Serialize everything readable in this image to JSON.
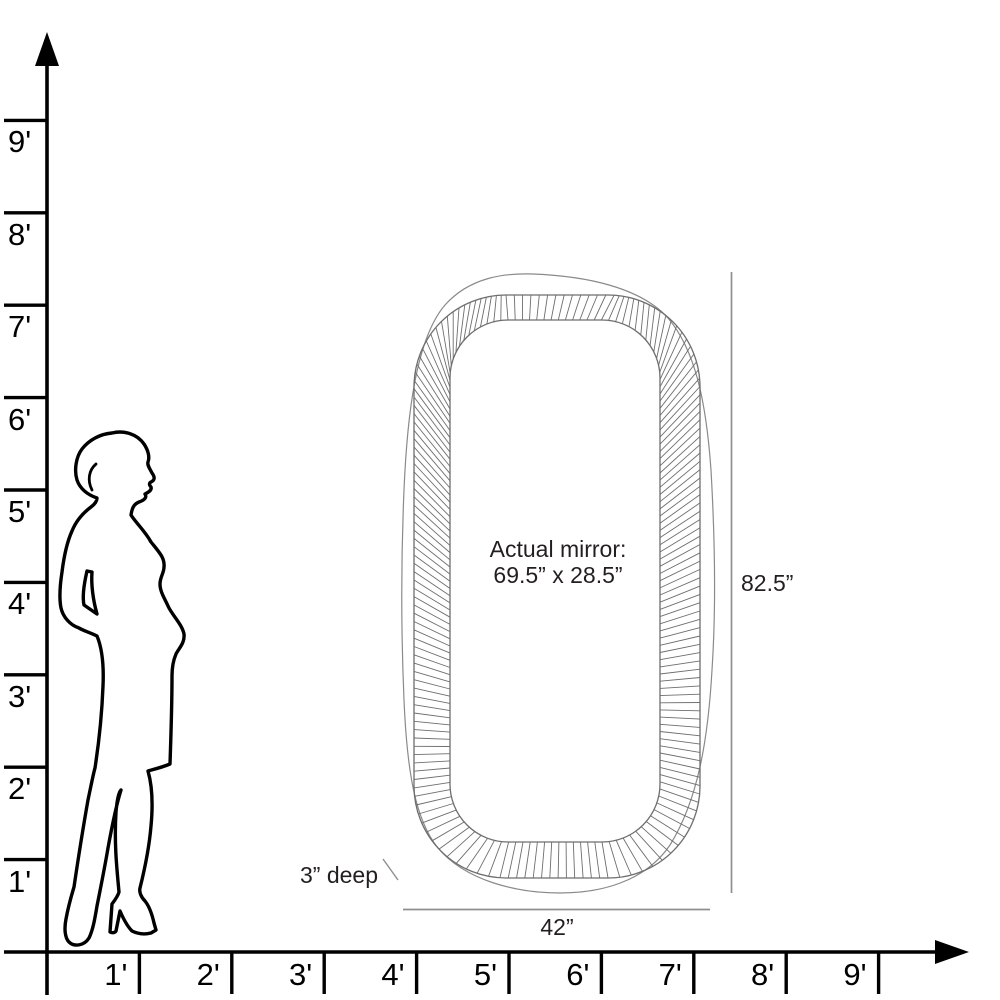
{
  "diagram": {
    "type": "product-size-comparison",
    "vertical_axis": {
      "unit": "feet",
      "labels": [
        "1'",
        "2'",
        "3'",
        "4'",
        "5'",
        "6'",
        "7'",
        "8'",
        "9'"
      ]
    },
    "horizontal_axis": {
      "unit": "feet",
      "labels": [
        "1'",
        "2'",
        "3'",
        "4'",
        "5'",
        "6'",
        "7'",
        "8'",
        "9'"
      ]
    },
    "figure": {
      "icon": "woman-silhouette"
    },
    "mirror": {
      "label_line1": "Actual mirror:",
      "label_line2": "69.5” x 28.5”",
      "height_label": "82.5”",
      "width_label": "42”",
      "depth_label": "3” deep"
    },
    "colors": {
      "axis": "#000000",
      "silhouette": "#000000",
      "mirror_line": "#6e6e6e",
      "mirror_outer_line": "#8a8a8a",
      "dimension_line": "#8f8f8f",
      "text": "#231f20",
      "background": "#ffffff"
    }
  }
}
